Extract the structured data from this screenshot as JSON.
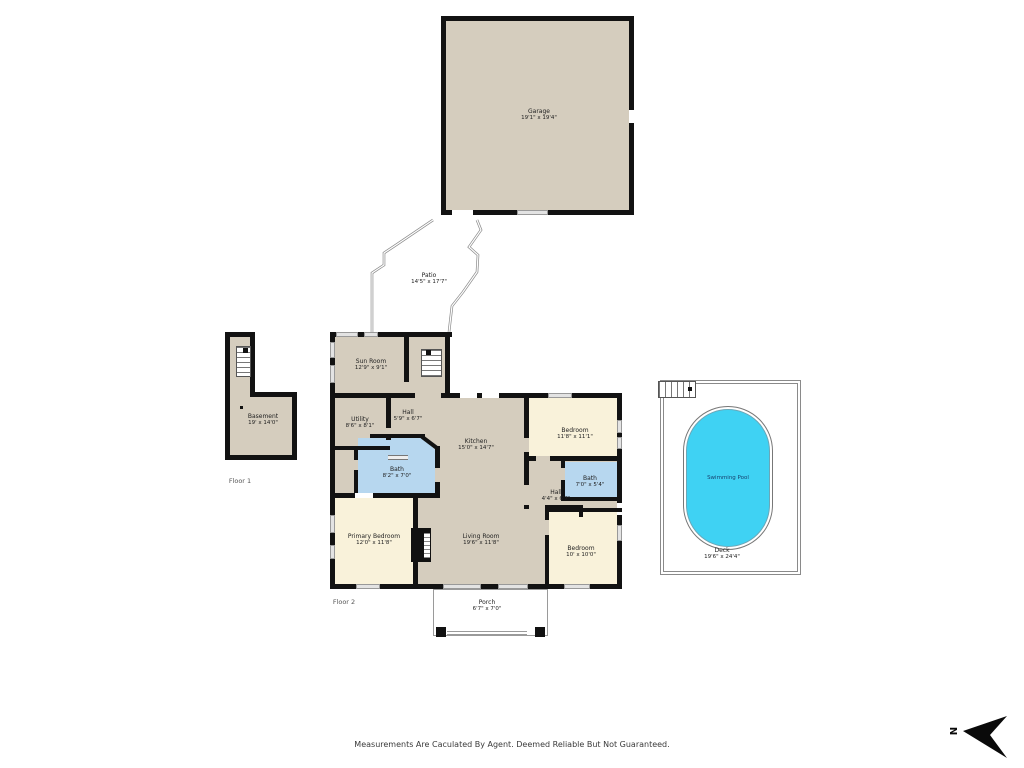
{
  "disclaimer": "Measurements Are Caculated By Agent. Deemed Reliable But Not Guaranteed.",
  "floor_labels": {
    "floor1": "Floor 1",
    "floor2": "Floor 2"
  },
  "compass": {
    "north": "N"
  },
  "colors": {
    "wall": "#121212",
    "room_tan": "#d5cdbe",
    "room_cream": "#f9f2da",
    "room_blue": "#b7d7ef",
    "pool_cyan": "#3fd2f3",
    "outline_gray": "#9a9a9a"
  },
  "rooms": {
    "garage": {
      "name": "Garage",
      "dims": "19'1\" x 19'4\""
    },
    "patio": {
      "name": "Patio",
      "dims": "14'5\" x 17'7\""
    },
    "sun_room": {
      "name": "Sun Room",
      "dims": "12'9\" x 9'1\""
    },
    "basement": {
      "name": "Basement",
      "dims": "19' x 14'0\""
    },
    "utility": {
      "name": "Utility",
      "dims": "8'6\" x 8'1\""
    },
    "hall_upper": {
      "name": "Hall",
      "dims": "5'9\" x 6'7\""
    },
    "kitchen": {
      "name": "Kitchen",
      "dims": "15'0\" x 14'7\""
    },
    "bath_main": {
      "name": "Bath",
      "dims": "8'2\" x 7'0\""
    },
    "bedroom_right": {
      "name": "Bedroom",
      "dims": "11'8\" x 11'1\""
    },
    "bath_right": {
      "name": "Bath",
      "dims": "7'0\" x 5'4\""
    },
    "hall_lower": {
      "name": "Hall",
      "dims": "4'4\" x 6'7\""
    },
    "primary_bedroom": {
      "name": "Primary Bedroom",
      "dims": "12'0\" x 11'8\""
    },
    "living_room": {
      "name": "Living Room",
      "dims": "19'6\" x 11'8\""
    },
    "bedroom_bottom": {
      "name": "Bedroom",
      "dims": "10' x 10'0\""
    },
    "porch": {
      "name": "Porch",
      "dims": "6'7\" x 7'0\""
    },
    "swimming_pool": {
      "name": "Swimming Pool"
    },
    "deck": {
      "name": "Deck",
      "dims": "19'6\" x 24'4\""
    }
  }
}
